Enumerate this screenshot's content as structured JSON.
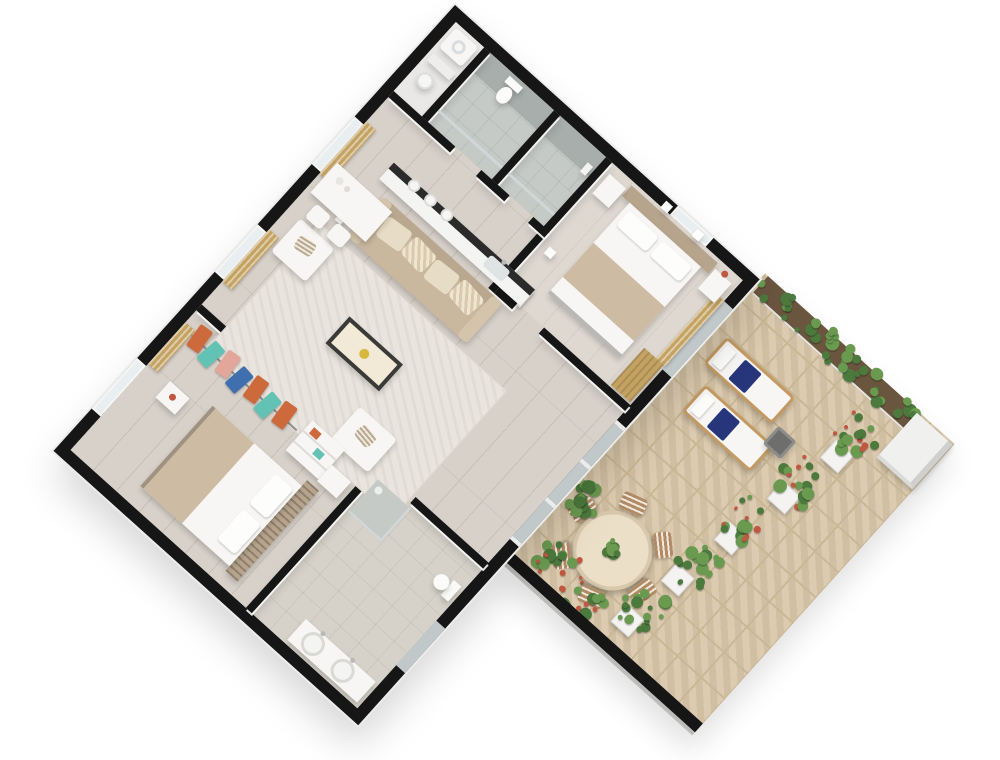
{
  "title": "3D rendered apartment floor plan with terrace",
  "view": "isometric top-down render, plan rotated ~42 degrees, white background, cut black wall tops",
  "palette": {
    "wall": "#161616",
    "floor": "#d8d1ca",
    "floor_line": "#c7bfb6",
    "floor_bed": "#ded8d1",
    "bath_floor": "#c6cac7",
    "bath_accent": "#a7aeab",
    "bath3_floor": "#d6d2c9",
    "terrace": "#d9c7a9",
    "terrace_line": "#c9b795",
    "white": "#f7f6f4",
    "glass": "#cfd8da",
    "curtain": "#c3a262",
    "sofa": "#c9b79e",
    "sofa_back": "#b9a88f",
    "cushion_light": "#e7dcc6",
    "cushion_dark": "#d9c9ae",
    "rug": "#e9e4dd",
    "cream": "#ecdfc8",
    "wood": "#c49a62",
    "navy": "#27367b",
    "chair": "#b18a66",
    "headboard": "#b7a48d",
    "blanket": "#cdbba4",
    "counter_top": "#2b2b2b",
    "leaf": "#4c7a3d",
    "leaf2": "#6a9a50",
    "flower": "#bf5741",
    "soil": "#6a553f",
    "gold_flower": "#d8b83a"
  },
  "rooms": [
    {
      "id": "laundry",
      "label": "utility room"
    },
    {
      "id": "bathroom-1",
      "label": "bathroom with toilet"
    },
    {
      "id": "bathroom-2",
      "label": "shower room"
    },
    {
      "id": "master-bedroom",
      "label": "master bedroom"
    },
    {
      "id": "hallway",
      "label": "hallway"
    },
    {
      "id": "living-room",
      "label": "living room with kitchenette counter"
    },
    {
      "id": "walk-in-closet",
      "label": "walk-in closet"
    },
    {
      "id": "bedroom-2",
      "label": "second bedroom"
    },
    {
      "id": "bathroom-3",
      "label": "bathroom with double sinks"
    },
    {
      "id": "terrace",
      "label": "stone paved terrace"
    }
  ],
  "furniture": [
    "beige sofa with striped cushions",
    "two white armchairs",
    "coffee table with yellow flower dish",
    "textured area rug",
    "white desk with two cube chairs",
    "kitchen counter with plates and sink",
    "double bed with beige blanket (master)",
    "double bed with slatted headboard (bedroom 2)",
    "nightstands",
    "toilets",
    "walk-in shower",
    "double vessel sinks",
    "washing machine",
    "hanging clothes rack",
    "wardrobe shelves"
  ],
  "terrace_items": {
    "sun_loungers": 2,
    "lounger_cushion_color": "navy",
    "side_table": 1,
    "dining_table_shape": "round",
    "dining_chairs": 6,
    "hedge_along_top": true,
    "planter_row": [
      {
        "x": 176,
        "y": 62,
        "type": "red"
      },
      {
        "x": 164,
        "y": 128,
        "type": "red"
      },
      {
        "x": 152,
        "y": 194,
        "type": "red"
      },
      {
        "x": 140,
        "y": 260,
        "type": "green"
      },
      {
        "x": 130,
        "y": 324,
        "type": "green"
      }
    ],
    "parapet_shrubs": [
      {
        "x": 8,
        "y": 334,
        "w": 56,
        "h": 44,
        "type": "red"
      },
      {
        "x": 64,
        "y": 346,
        "w": 62,
        "h": 40,
        "type": "red"
      },
      {
        "x": 0,
        "y": 266,
        "w": 40,
        "h": 44,
        "type": "green"
      }
    ]
  },
  "clothes_colors": [
    "#cd6a3c",
    "#62c2b4",
    "#e2a69b",
    "#3f6fae",
    "#cd6a3c",
    "#62c2b4",
    "#cd6a3c"
  ]
}
